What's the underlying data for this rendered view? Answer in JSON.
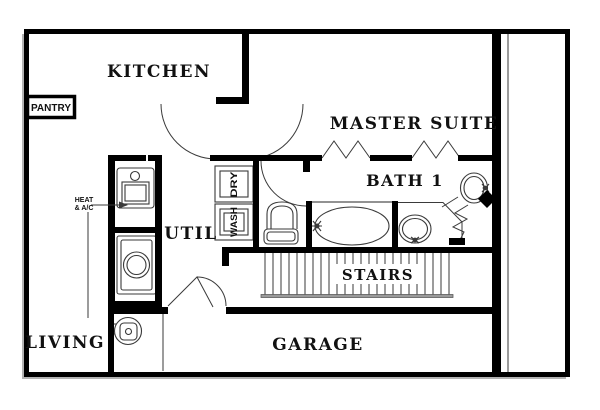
{
  "figure": {
    "type": "floor-plan",
    "floor": "first-floor"
  },
  "rooms": {
    "kitchen": {
      "label": "KITCHEN"
    },
    "pantry": {
      "label": "PANTRY"
    },
    "master_suite": {
      "label": "MASTER SUITE"
    },
    "bath1": {
      "label": "BATH 1"
    },
    "util": {
      "label": "UTIL"
    },
    "stairs": {
      "label": "STAIRS"
    },
    "living": {
      "label": "LIVING"
    },
    "garage": {
      "label": "GARAGE"
    }
  },
  "labels": {
    "heat_ac": {
      "line1": "HEAT",
      "line2": "& A/C"
    },
    "dryer": "DRY",
    "washer": "WASH"
  },
  "fixtures": {
    "toilet": "toilet",
    "bathtub": "bathtub",
    "sink_left": "sink",
    "sink_right": "sink",
    "furnace": "heat-ac-unit",
    "water_heater_closet": "water-heater",
    "water_heater_garage": "water-heater"
  },
  "colors": {
    "wall": "#000000",
    "background": "#ffffff",
    "thin_line": "#3a3a3a",
    "shadow": "#b3b3b3",
    "handrail": "#9a9a9a"
  }
}
